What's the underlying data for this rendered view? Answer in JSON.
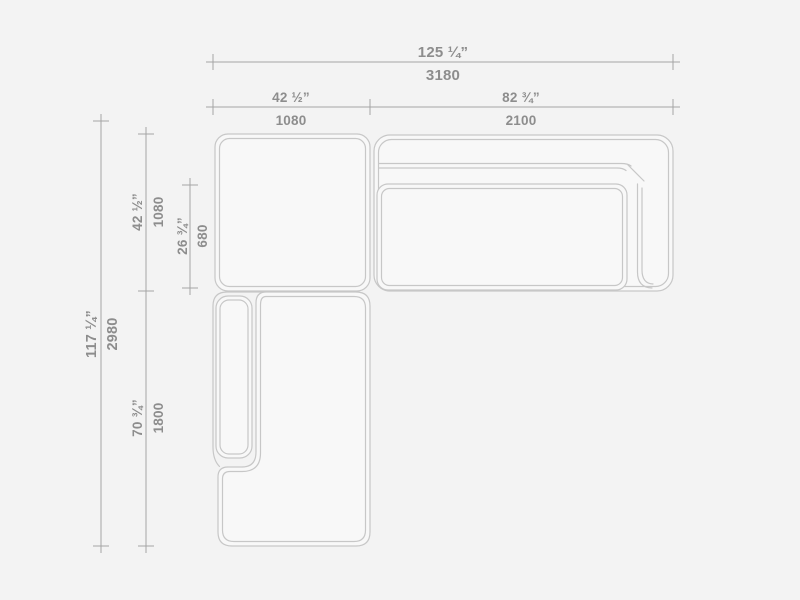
{
  "page": {
    "background_color": "#f3f3f3",
    "description": "Technical top-view dimension drawing of a modular corner sofa with ottoman module and chaise"
  },
  "drawing_colors": {
    "piece_outline": "#c7c7c7",
    "piece_fill": "#f8f8f8",
    "dimension_line": "#a5a5a5",
    "label_text": "#8d8d8d"
  },
  "pieces": [
    "square-ottoman-module",
    "right-sofa-with-back-and-arm",
    "sofa-seat-cushion",
    "chaise-module-with-left-arm",
    "chaise-armrest-cushion"
  ],
  "dimensions": {
    "top_total": {
      "inches": "125 ¼”",
      "mm": "3180"
    },
    "top_left_segment": {
      "inches": "42 ½”",
      "mm": "1080"
    },
    "top_right_segment": {
      "inches": "82 ¾”",
      "mm": "2100"
    },
    "side_total": {
      "inches": "117 ¼”",
      "mm": "2980"
    },
    "side_top_segment": {
      "inches": "42 ½”",
      "mm": "1080"
    },
    "side_seat_depth": {
      "inches": "26 ¾”",
      "mm": "680"
    },
    "side_chaise_segment": {
      "inches": "70 ¾”",
      "mm": "1800"
    }
  }
}
